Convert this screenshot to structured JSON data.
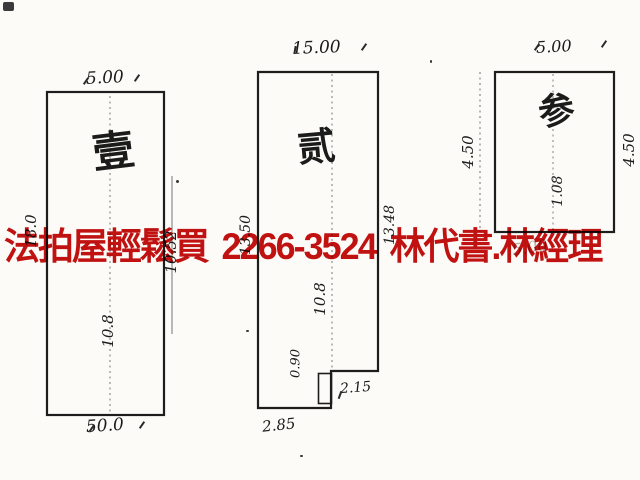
{
  "overlay": {
    "ad_text": "法拍屋輕鬆買 2266-3524 林代書.林經理",
    "ad_color": "#c41212"
  },
  "diagram": {
    "type": "land-survey-sketch",
    "ink_color": "#1d1d1d",
    "paper_color": "#fcfbf7",
    "parcels": {
      "p1": {
        "num": "壹",
        "top": "5.00",
        "bottom": "50.0",
        "side_left": "18.0",
        "side_right": "10.52",
        "inner": "10.8"
      },
      "p2": {
        "num": "贰",
        "top": "15.00",
        "bottom": "2.85",
        "notch": "2.15",
        "side_left": "13.50",
        "side_right": "13.48",
        "inner": "10.8",
        "inner2": "0.90"
      },
      "p3": {
        "num": "参",
        "top": "5.00",
        "side_left": "4.50",
        "side_right": "4.50",
        "inner": "1.08",
        "ghost": "5.00"
      }
    }
  }
}
